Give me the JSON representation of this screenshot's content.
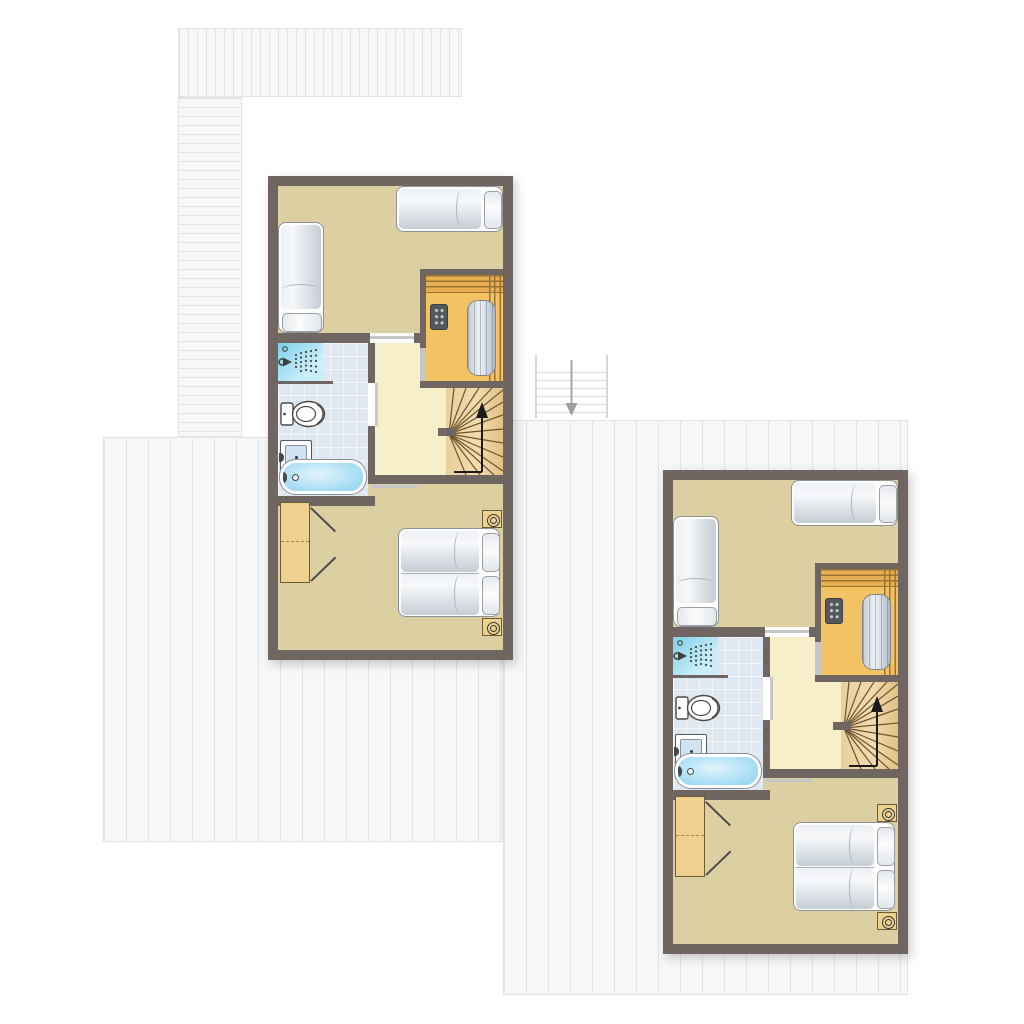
{
  "colors": {
    "background": "#ffffff",
    "wall": "#6f6661",
    "bedroom_floor": "#dcd0a2",
    "hall_floor": "#f7efca",
    "sauna_floor": "#f3c363",
    "sauna_wood_slat": "#e8ae52",
    "sauna_slat_line": "#9a7231",
    "stair_wood": "#ecd4a4",
    "stair_tread_line": "#6f5330",
    "bathroom_tile": "#dfe7f1",
    "tile_grid": "#f3f7fb",
    "shower_glass": "#7fd0e9",
    "bath_water": "#a5dcf5",
    "furniture_wood": "#efd18f",
    "deck_fill": "#f7f7f8",
    "deck_line": "#e3e3e6",
    "stove_body": "#54585c",
    "door_leaf": "#c4c6c8",
    "arrow_gray": "#9aa0a4",
    "arrow_black": "#1b1b1b"
  },
  "floor_plan": {
    "units": [
      {
        "name": "unit-left"
      },
      {
        "name": "unit-right"
      }
    ],
    "room_symbols": [
      "bedroom",
      "second-bedroom",
      "bathroom",
      "hallway",
      "sauna",
      "winder-staircase"
    ],
    "furniture_symbols": [
      "single-bed",
      "double-bed",
      "pillow",
      "wardrobe",
      "bedside-lamp",
      "sauna-bench",
      "sauna-stove",
      "shower",
      "toilet",
      "washbasin",
      "bathtub",
      "stair-direction-arrow",
      "exterior-steps",
      "down-arrow",
      "decking-planks"
    ]
  }
}
